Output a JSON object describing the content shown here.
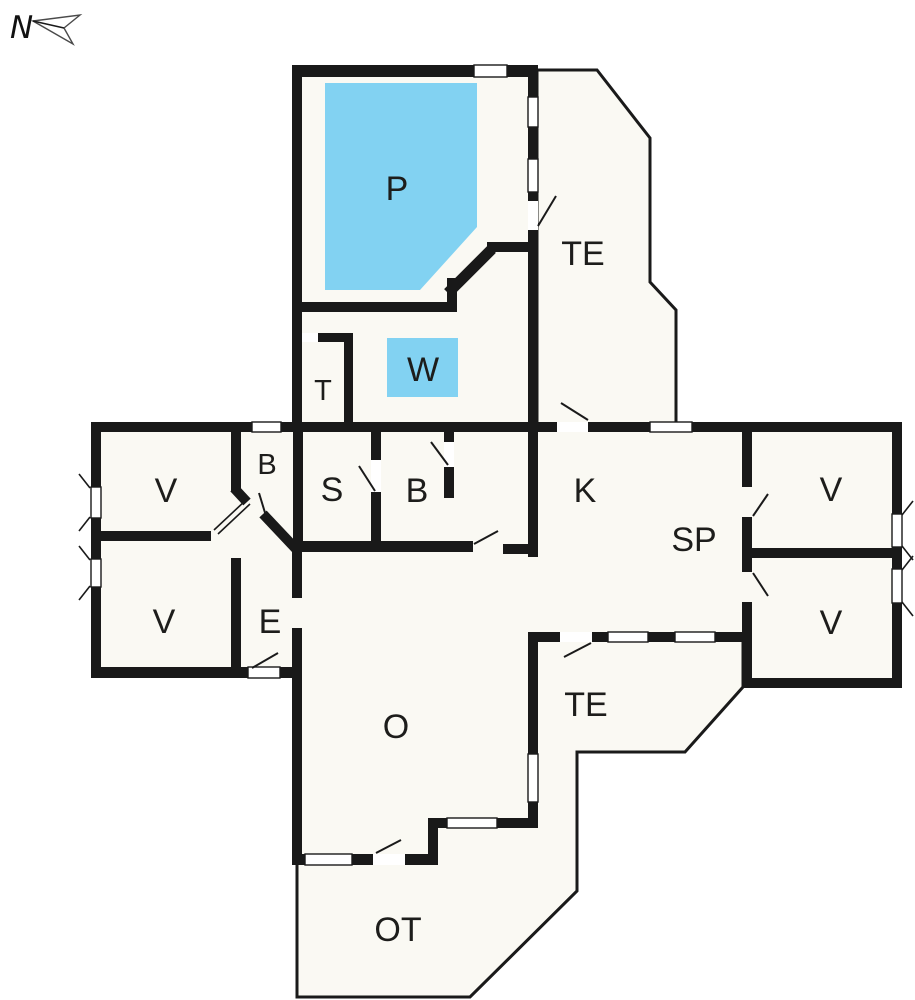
{
  "compass": {
    "label": "N"
  },
  "colors": {
    "wall": "#191919",
    "floor": "#faf9f3",
    "water": "#82d2f2",
    "line": "#1a1a1a",
    "paper": "#ffffff"
  },
  "rooms": {
    "pool": {
      "label": "P"
    },
    "terrace_upper": {
      "label": "TE"
    },
    "whirlpool": {
      "label": "W"
    },
    "toilet": {
      "label": "T"
    },
    "bathroom_left": {
      "label": "B"
    },
    "bedroom_top_left": {
      "label": "V"
    },
    "sauna": {
      "label": "S"
    },
    "bathroom_center": {
      "label": "B"
    },
    "kitchen": {
      "label": "K"
    },
    "dining": {
      "label": "SP"
    },
    "bedroom_top_right": {
      "label": "V"
    },
    "bedroom_bottom_left": {
      "label": "V"
    },
    "entrance": {
      "label": "E"
    },
    "bedroom_bottom_right": {
      "label": "V"
    },
    "living_room": {
      "label": "O"
    },
    "terrace_lower": {
      "label": "TE"
    },
    "open_terrace": {
      "label": "OT"
    }
  }
}
